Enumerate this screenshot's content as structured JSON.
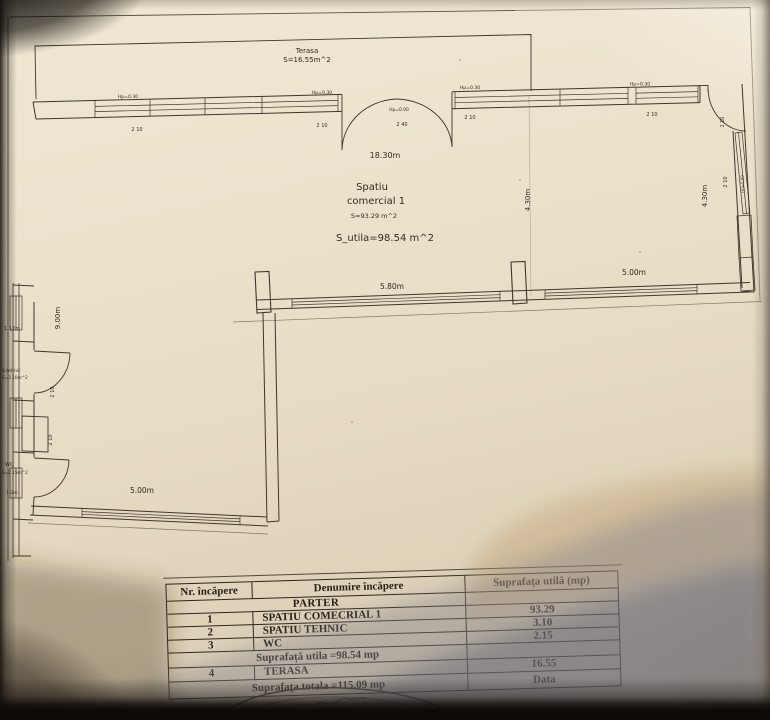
{
  "plan": {
    "terasa_label": "Terasa",
    "terasa_area": "S=16.55m^2",
    "room_name_1": "Spatiu",
    "room_name_2": "comercial 1",
    "room_area": "S=93.29 m^2",
    "usable_area": "S_utila=98.54 m^2",
    "dim_top_width": "18.30m",
    "dim_left_height": "9.00m",
    "dim_right_height": "4.30m",
    "dim_bottom_1": "5.80m",
    "dim_bottom_2": "5.00m",
    "dim_ext_bottom": "5.00m",
    "lbl_hp030": "Hp=0.30",
    "lbl_hp000": "Hp=0.00",
    "lbl_hp090": "Hp=0.90",
    "lbl_210": "2 10",
    "lbl_240": "2 40",
    "annex": {
      "dim_a": "1.12m",
      "tehnic_name": "S.tehnic",
      "tehnic_area": "S=3.10m^2",
      "wc_name": "WC",
      "wc_area": "S=2.15m^2",
      "dim_b": "1.2m"
    }
  },
  "table": {
    "headers": [
      "Nr. încăpere",
      "Denumire încăpere",
      "Suprafața utilă (mp)"
    ],
    "section_label": "PARTER",
    "rows": [
      {
        "nr": "1",
        "name": "SPATIU COMECRIAL 1",
        "area": "93.29"
      },
      {
        "nr": "2",
        "name": "SPATIU TEHNIC",
        "area": "3.10"
      },
      {
        "nr": "3",
        "name": "WC",
        "area": "2.15"
      }
    ],
    "subtotal_label": "Suprafață utila =98.54 mp",
    "terasa_row": {
      "nr": "4",
      "name": "TERASA",
      "area": "16.55"
    },
    "total_label": "Suprafața totala =115.09 mp",
    "data_label": "Data"
  }
}
